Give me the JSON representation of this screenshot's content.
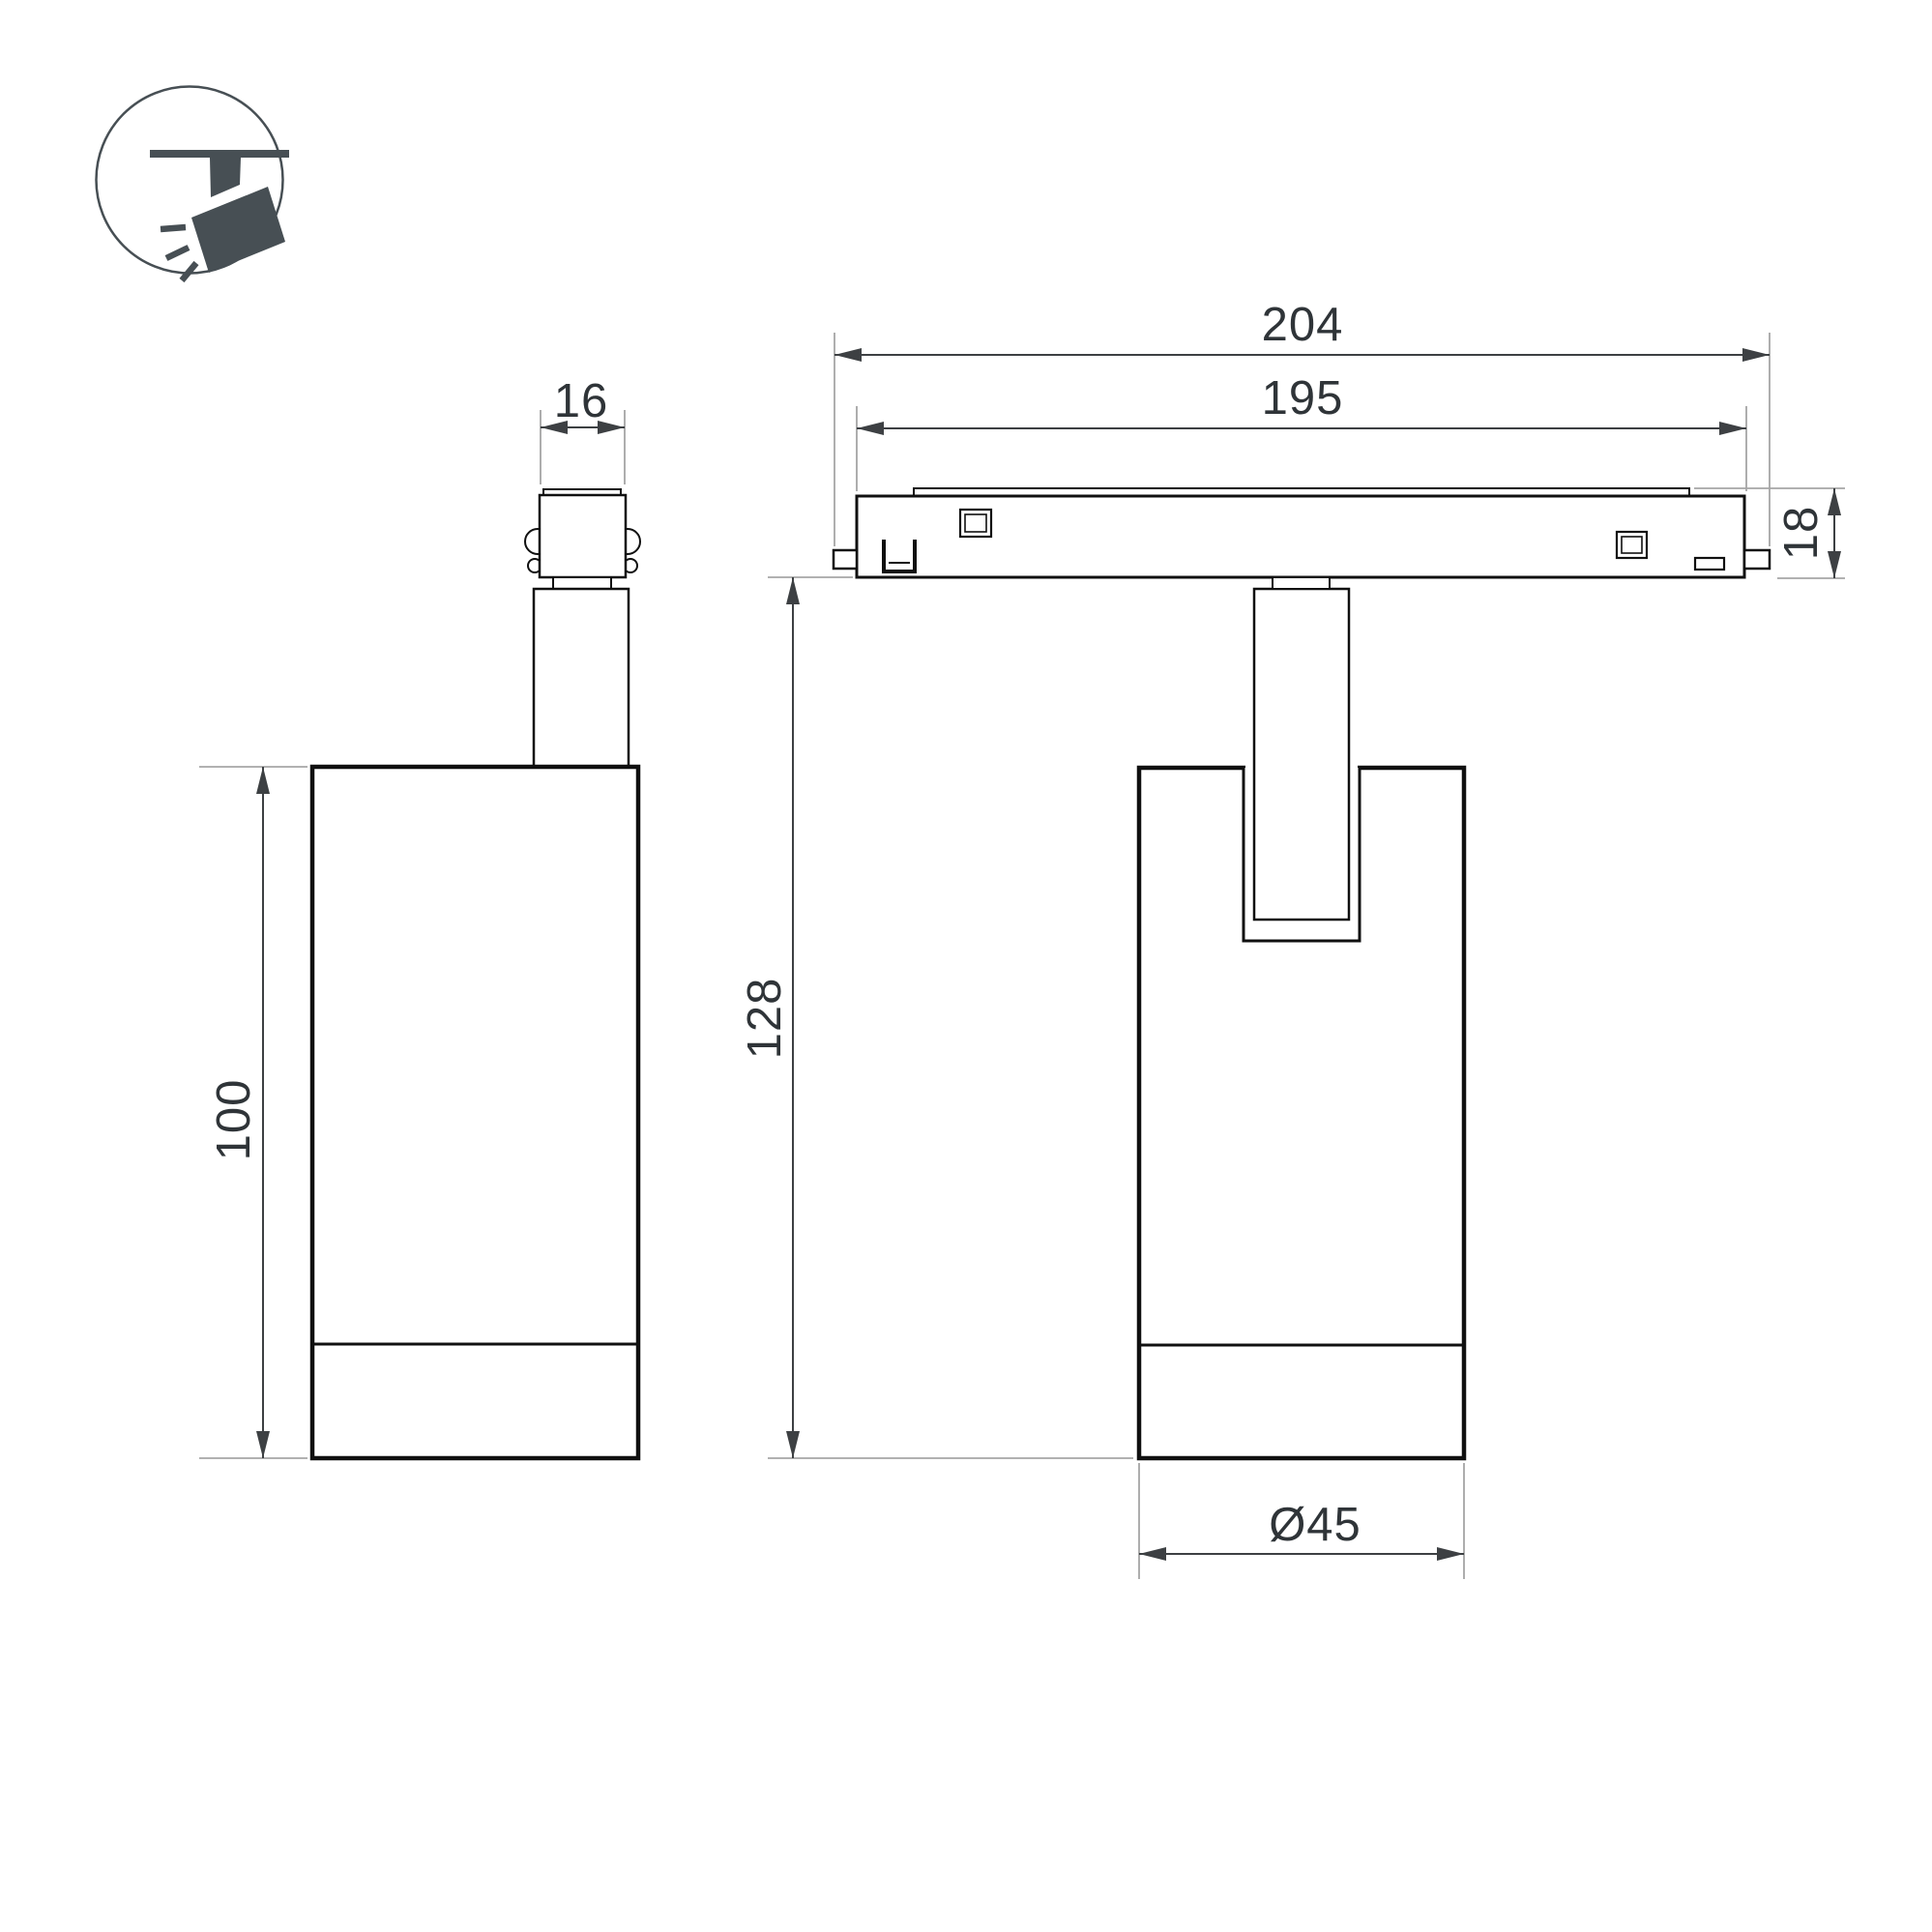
{
  "drawing": {
    "icon": {
      "label": "track-spotlight"
    },
    "views": {
      "side": {
        "dims": {
          "adapter_width": "16",
          "body_height": "100"
        }
      },
      "front": {
        "dims": {
          "track_outer_length": "204",
          "track_inner_length": "195",
          "track_height": "18",
          "overall_height": "128",
          "body_diameter": "Ø45"
        }
      }
    },
    "colors": {
      "background": "#ffffff",
      "object_line": "#101010",
      "dimension_line": "#3d4043",
      "extension_line": "#a6a6a6",
      "text": "#2f3438",
      "icon_fill": "#474f54"
    }
  }
}
